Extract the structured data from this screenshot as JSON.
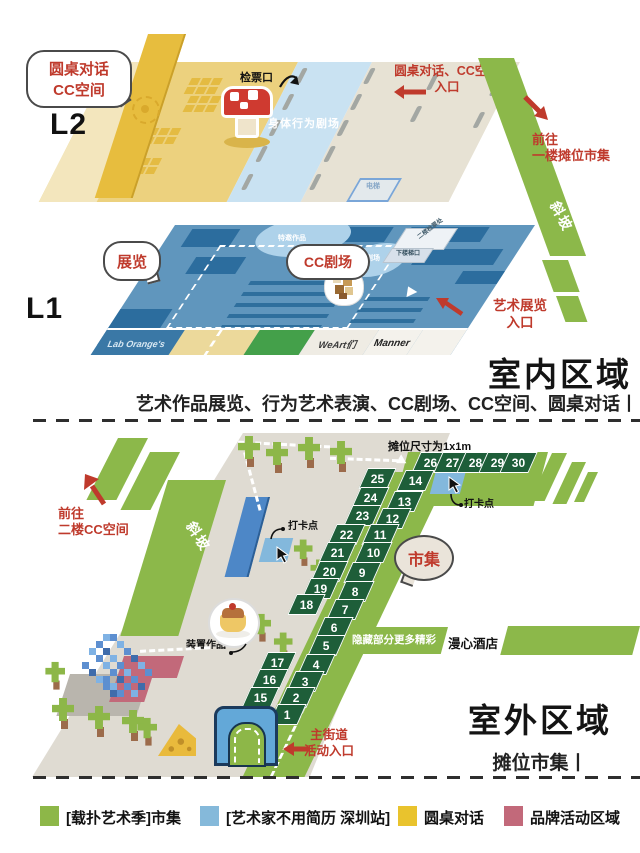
{
  "indoor": {
    "title": "室内区域",
    "subtitle": "艺术作品展览、行为艺术表演、CC剧场、CC空间、圆桌对话丨",
    "l2": {
      "label": "L2",
      "roundtable_bubble": "圆桌对话\nCC空间",
      "ticket_gate": "检票口",
      "body_theater": "身体行为剧场",
      "entrance_note": "圆桌对话、CC空间\n入口",
      "elevator": "电梯"
    },
    "ramp": {
      "label": "斜坡",
      "note": "前往\n一楼摊位市集"
    },
    "l1": {
      "label": "L1",
      "exhibition_bubble": "展览",
      "cc_theater_bubble": "CC剧场",
      "oval1": "特邀作品",
      "oval2": "轻重剧场",
      "stairs_top": "二楼检票处",
      "stairs_front": "下楼梯口",
      "art_entrance": "艺术展览\n入口",
      "tenants": [
        "Lab Orange's",
        "",
        "WeArt们",
        "Manner",
        "出口"
      ]
    }
  },
  "outdoor": {
    "title": "室外区域",
    "subtitle": "摊位市集丨",
    "stall_size_note": "摊位尺寸为1x1m",
    "market_bubble": "市集",
    "checkin1": "打卡点",
    "checkin2": "打卡点",
    "hidden_note": "隐藏部分更多精彩",
    "hotel": "漫心酒店",
    "ramp_label": "斜坡",
    "to_cc_note": "前往\n二楼CC空间",
    "installation_label": "装置作品",
    "gate_note": "主街道\n活动入口",
    "stalls_top": [
      26,
      27,
      28,
      29,
      30
    ],
    "stalls_left": [
      25,
      24,
      23,
      22,
      21,
      20,
      19,
      18,
      17,
      16,
      15
    ],
    "stalls_right": [
      14,
      13,
      12,
      11,
      10,
      9,
      8,
      7,
      6,
      5,
      4,
      3,
      2,
      1
    ]
  },
  "legend": {
    "items": [
      {
        "label": "[载扑艺术季]市集",
        "color": "#8db748"
      },
      {
        "label": "[艺术家不用简历 深圳站]",
        "color": "#85b9da"
      },
      {
        "label": "圆桌对话",
        "color": "#e9c32d"
      },
      {
        "label": "品牌活动区域",
        "color": "#c2697a"
      }
    ]
  }
}
